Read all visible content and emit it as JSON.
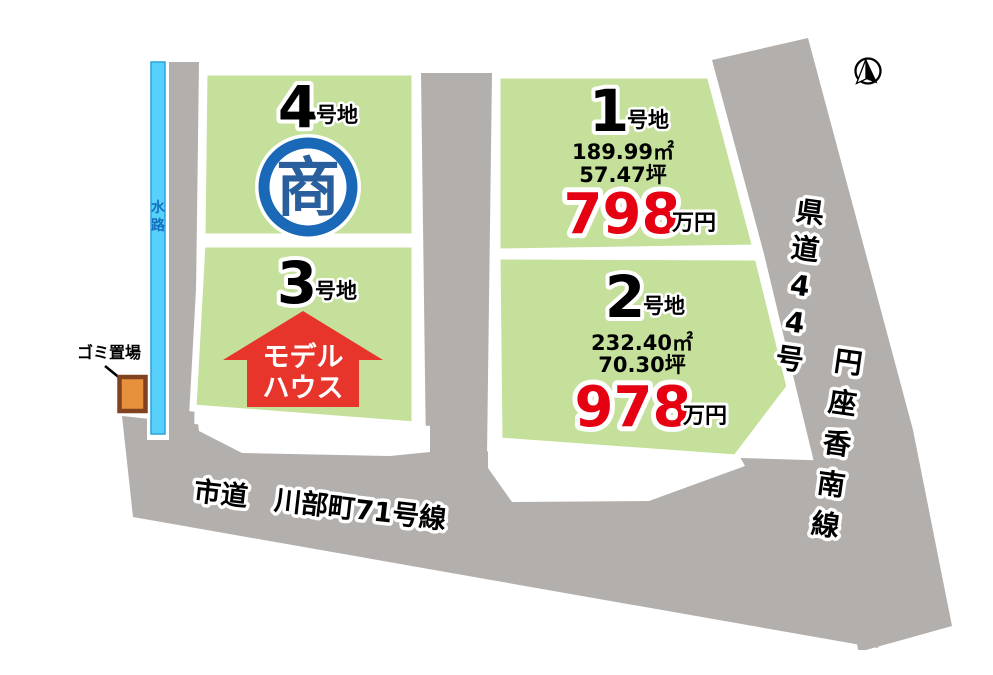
{
  "compass": {
    "icon": "north-arrow"
  },
  "waterway": {
    "label": "水路"
  },
  "garbage": {
    "label": "ゴミ置場"
  },
  "roads": {
    "bottom_label": "市道　川部町71号線",
    "right_label_1": "県道44号",
    "right_label_2": "円座香南線"
  },
  "plots": {
    "p1": {
      "number": "1",
      "suffix": "号地",
      "area_m2": "189.99㎡",
      "area_tsubo": "57.47坪",
      "price": "798",
      "price_unit": "万円"
    },
    "p2": {
      "number": "2",
      "suffix": "号地",
      "area_m2": "232.40㎡",
      "area_tsubo": "70.30坪",
      "price": "978",
      "price_unit": "万円"
    },
    "p3": {
      "number": "3",
      "suffix": "号地",
      "overlay_line1": "モデル",
      "overlay_line2": "ハウス"
    },
    "p4": {
      "number": "4",
      "suffix": "号地",
      "status_mark": "商"
    }
  },
  "colors": {
    "plot_green": "#c4e09b",
    "road_gray": "#b3afad",
    "water_cyan": "#57d1fb",
    "water_edge": "#2aa3de",
    "price_red": "#e50012",
    "status_blue": "#1a68b8",
    "arrow_red": "#e7352b",
    "garbage_orange": "#e8913c",
    "garbage_border": "#81431f"
  }
}
